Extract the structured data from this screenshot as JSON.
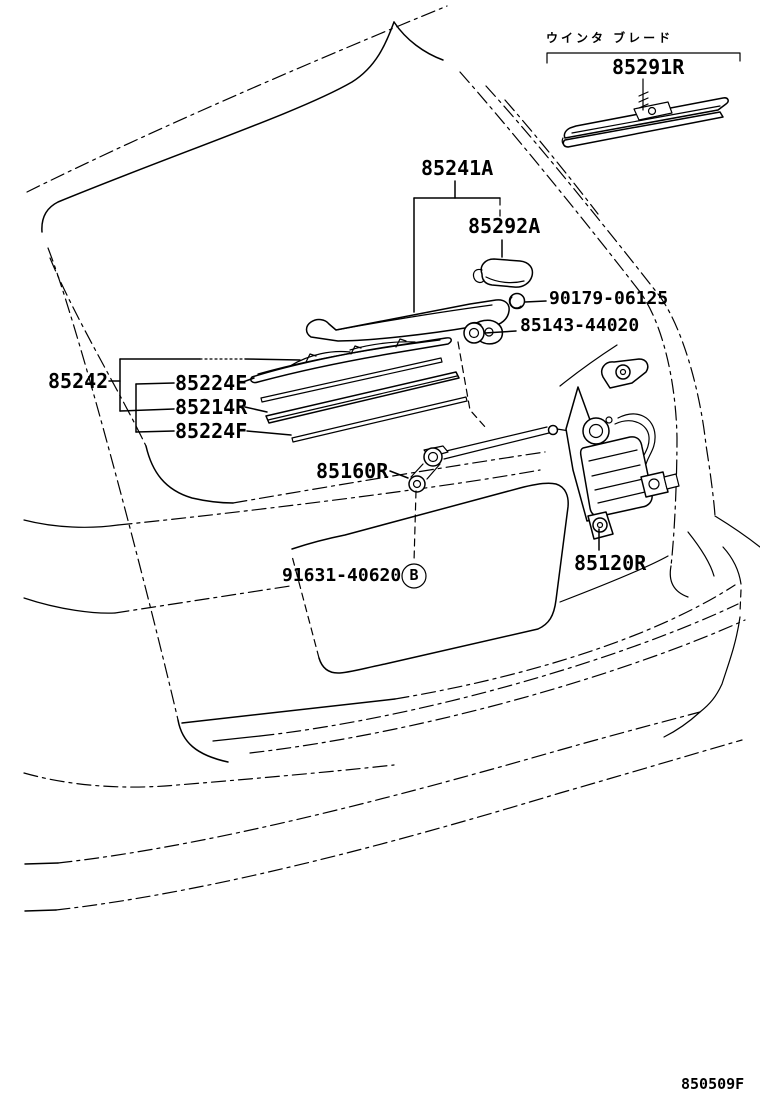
{
  "diagram": {
    "kind": "toyota-epc-rear-wiper-illustration",
    "note_jp": "ウインタ ブレード",
    "drawing_code": "850509F",
    "colors": {
      "line": "#000000",
      "background": "#ffffff"
    },
    "labels": {
      "winter_blade": "85291R",
      "arm_assy": "85241A",
      "arm_head_cover": "85292A",
      "arm_nut": "90179-06125",
      "pivot_cap_nut": "85143-44020",
      "blade_assy": "85242",
      "blade_rubber_e": "85224E",
      "blade_r": "85214R",
      "blade_rubber_f": "85224F",
      "pivot": "85160R",
      "grommet": "91631-40620",
      "grommet_marker": "B",
      "motor": "85120R"
    }
  }
}
